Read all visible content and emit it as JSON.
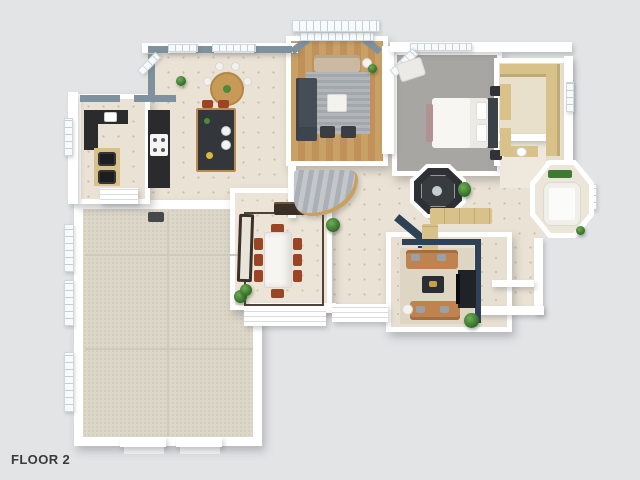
{
  "floor_label": "FLOOR 2",
  "palette": {
    "background": "#e3e4e6",
    "wall_white": "#ffffff",
    "tile_floor": "#eae2d4",
    "garage_floor": "#dcd7c9",
    "wood_floor": "#c9a066",
    "carpet_gray": "#a7a6a2",
    "rug_gray": "#a9aeb2",
    "living_rug": "#ded5c3",
    "slate_wall": "#7d919e",
    "navy_wall": "#2e4157",
    "counter_dark": "#2b2b2d",
    "island_dark": "#33363b",
    "cabinet_tan": "#d9c289",
    "wood_trim": "#b98d52",
    "sofa_beige": "#cbb9a2",
    "sofa_charcoal": "#454e57",
    "sofa_tan": "#bf8350",
    "chair_red": "#9c4526",
    "marble_white": "#f7f5f1",
    "dining_floor": "#ece4d6",
    "bath_floor": "#ece6d9",
    "closet_floor": "#e8e0cb",
    "media_dark": "#1f2327",
    "plant_green": "#3f7a34",
    "stair_carpet": "#b6bbc0",
    "label_color": "#3a3a3a"
  }
}
